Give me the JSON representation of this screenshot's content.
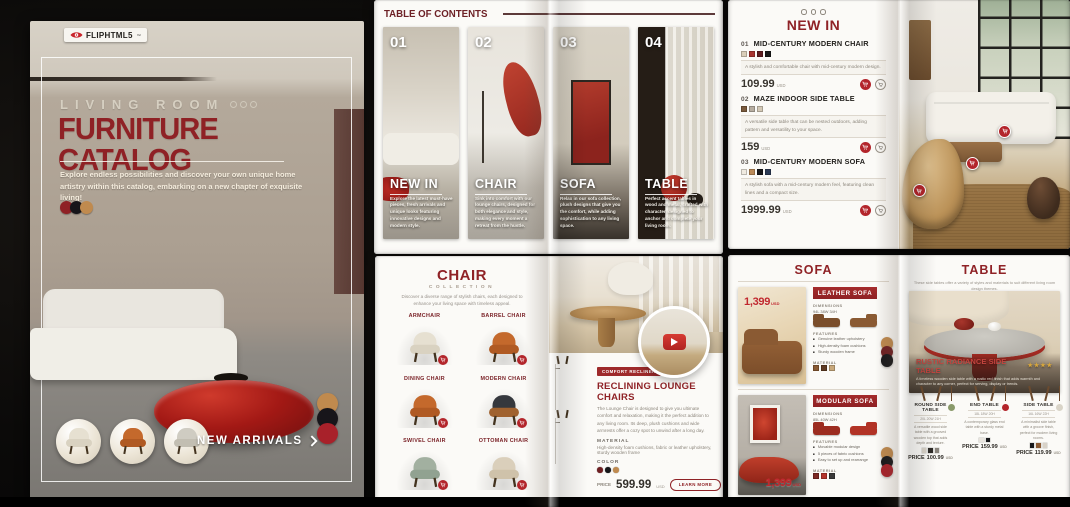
{
  "accent": {
    "maroon": "#8f2226",
    "red": "#b3252b",
    "gold": "#c08a4e",
    "banner": "#9e2a2b"
  },
  "cover": {
    "brand": "FLIPHTML5",
    "brand_mark": "™",
    "eyebrow": "LIVING ROOM",
    "title": "FURNITURE CATALOG",
    "subtitle": "Explore endless possibilities and discover your own unique home artistry within this catalog, embarking on a new chapter of exquisite living!",
    "cta": "NEW ARRIVALS",
    "palette": [
      "#8f2125",
      "#17151a",
      "#c08a4e"
    ],
    "side_palette": [
      "#c08a4e",
      "#17151a",
      "#a8212a"
    ]
  },
  "toc": {
    "header": "TABLE OF CONTENTS",
    "items": [
      {
        "num": "01",
        "label": "NEW IN",
        "desc": "Explore the latest must-have pieces, fresh arrivals and unique looks featuring innovative designs and modern style."
      },
      {
        "num": "02",
        "label": "CHAIR",
        "desc": "Sink into comfort with our lounge chairs, designed for both elegance and style, making every moment a retreat from the hustle."
      },
      {
        "num": "03",
        "label": "SOFA",
        "desc": "Relax in our sofa collection, plush designs that give you the comfort, while adding sophistication to any living space."
      },
      {
        "num": "04",
        "label": "TABLE",
        "desc": "Perfect accent tables in wood and metal, crafted with character, designed to anchor and complete your living room."
      }
    ]
  },
  "new_in": {
    "title": "NEW IN",
    "currency": "USD",
    "items": [
      {
        "num": "01",
        "name": "MID-CENTURY MODERN CHAIR",
        "desc": "A stylish and comfortable chair with mid-century modern design.",
        "price": "109.99",
        "swatches": [
          "#d9cdb8",
          "#a8342f",
          "#5f1d20",
          "#191919"
        ]
      },
      {
        "num": "02",
        "name": "MAZE INDOOR SIDE TABLE",
        "desc": "A versatile side table that can be nested outdoors, adding pattern and versatility to your space.",
        "price": "159",
        "swatches": [
          "#7a5a3c",
          "#b7ada0",
          "#d4c9b6"
        ]
      },
      {
        "num": "03",
        "name": "MID-CENTURY MODERN SOFA",
        "desc": "A stylish sofa with a mid-century modern feel, featuring clean lines and a compact size.",
        "price": "1999.99",
        "swatches": [
          "#f0ebe1",
          "#bb8a57",
          "#17171a",
          "#2c3a55"
        ]
      }
    ]
  },
  "chair": {
    "title": "CHAIR",
    "subtitle": "COLLECTION",
    "desc": "Discover a diverse range of stylish chairs, each designed to enhance your living space with timeless appeal.",
    "grid": [
      {
        "name": "ARMCHAIR"
      },
      {
        "name": "BARREL CHAIR"
      },
      {
        "name": "DINING CHAIR"
      },
      {
        "name": "MODERN CHAIR"
      },
      {
        "name": "SWIVEL CHAIR"
      },
      {
        "name": "OTTOMAN CHAIR"
      }
    ],
    "feature": {
      "tag": "COMFORT RECLINER",
      "name": "RECLINING LOUNGE CHAIRS",
      "desc": "The Lounge Chair is designed to give you ultimate comfort and relaxation, making it the perfect addition to any living room. Its deep, plush cushions and wide armrests offer a cozy spot to unwind after a long day.",
      "material_label": "MATERIAL",
      "material": "High-density foam cushions, fabric or leather upholstery, sturdy wooden frame",
      "color_label": "COLOR",
      "colors": [
        "#6e1f22",
        "#17171a",
        "#c08a4e"
      ],
      "price_label": "PRICE",
      "price": "599.99",
      "currency": "USD",
      "btn_more": "LEARN MORE",
      "btn_buy": "BUY NOW"
    }
  },
  "sofa": {
    "title": "SOFA",
    "dim_label": "DIMENSIONS",
    "features_label": "FEATURES",
    "material_label": "MATERIAL",
    "currency": "USD",
    "products": [
      {
        "banner": "LEATHER SOFA",
        "price_tag": "1,399",
        "dims": "94L 38W 34H",
        "features": [
          "Genuine leather upholstery",
          "High-density foam cushions",
          "Sturdy wooden frame"
        ],
        "material_sw": [
          "#8a5a33",
          "#5f3a22",
          "#c9a97c"
        ],
        "dots": [
          "#c08a4e",
          "#6e1f22",
          "#17171a"
        ]
      },
      {
        "banner": "MODULAR SOFA",
        "price_tag": "1,399",
        "dims": "85L 40W 42H",
        "features": [
          "Movable modular design",
          "5 pieces of fabric cushions",
          "Easy to set up and rearrange"
        ],
        "material_sw": [
          "#7e2a24",
          "#b5342c",
          "#3a3a3a"
        ],
        "dots": [
          "#c08a4e",
          "#17171a",
          "#a8212a"
        ]
      }
    ]
  },
  "table": {
    "title": "TABLE",
    "desc": "These side tables offer a variety of styles and materials to suit different living room design themes.",
    "feature": {
      "name": "RUSTIC RADIANCE SIDE TABLE",
      "stars": "★★★★",
      "desc": "A timeless wooden side table with a rustic red finish that adds warmth and character to any corner, perfect for serving, display or trends."
    },
    "price_label": "PRICE",
    "currency": "USD",
    "items": [
      {
        "name": "ROUND SIDE TABLE",
        "dims": "20L 20W 21H",
        "desc": "A versatile wood side table with a grooved wooden top that adds depth and texture.",
        "swatches": [
          "#d8d2c8",
          "#2e2b27",
          "#8a857d"
        ],
        "price": "100.99"
      },
      {
        "name": "END TABLE",
        "dims": "18L 18W 20H",
        "desc": "A contemporary glass end table with a sturdy metal base.",
        "swatches": [
          "#e8e4dd",
          "#17171a"
        ],
        "price": "159.99"
      },
      {
        "name": "SIDE TABLE",
        "dims": "16L 16W 22H",
        "desc": "A minimalist side table with a groove finish, perfect for modern living rooms.",
        "swatches": [
          "#17171a",
          "#8a5a33",
          "#d8d2c8"
        ],
        "price": "119.99"
      }
    ]
  }
}
